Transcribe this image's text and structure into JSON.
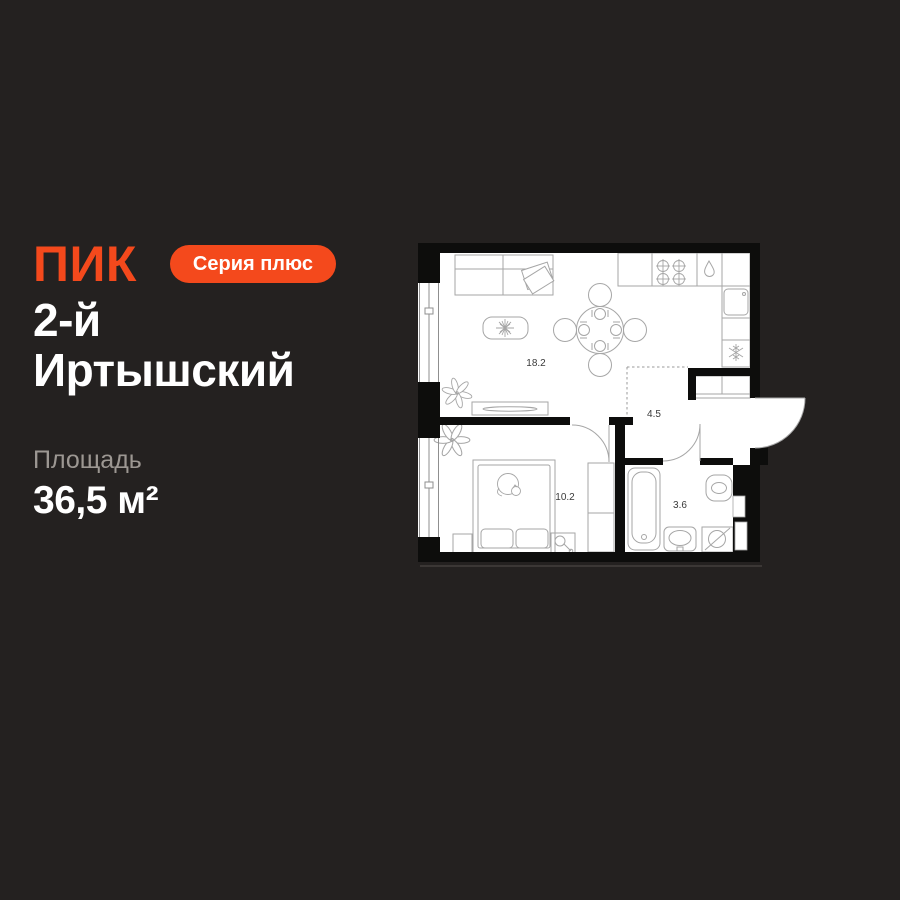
{
  "page": {
    "background": "#242120"
  },
  "brand": {
    "logo": "ПИК",
    "accent_color": "#F4491C",
    "badge": "Серия плюс",
    "badge_text_color": "#FFFFFF"
  },
  "project": {
    "title_line1": "2-й",
    "title_line2": "Иртышский"
  },
  "area": {
    "label": "Площадь",
    "value": "36,5 м²"
  },
  "floorplan": {
    "wall_color": "#0D0D0C",
    "floor_color": "#FFFFFF",
    "line_color": "#A6A6A6",
    "label_color": "#3A3A3A",
    "rooms": [
      {
        "id": "living-kitchen",
        "label": "18.2"
      },
      {
        "id": "hallway",
        "label": "4.5"
      },
      {
        "id": "bedroom",
        "label": "10.2"
      },
      {
        "id": "bathroom",
        "label": "3.6"
      }
    ]
  }
}
